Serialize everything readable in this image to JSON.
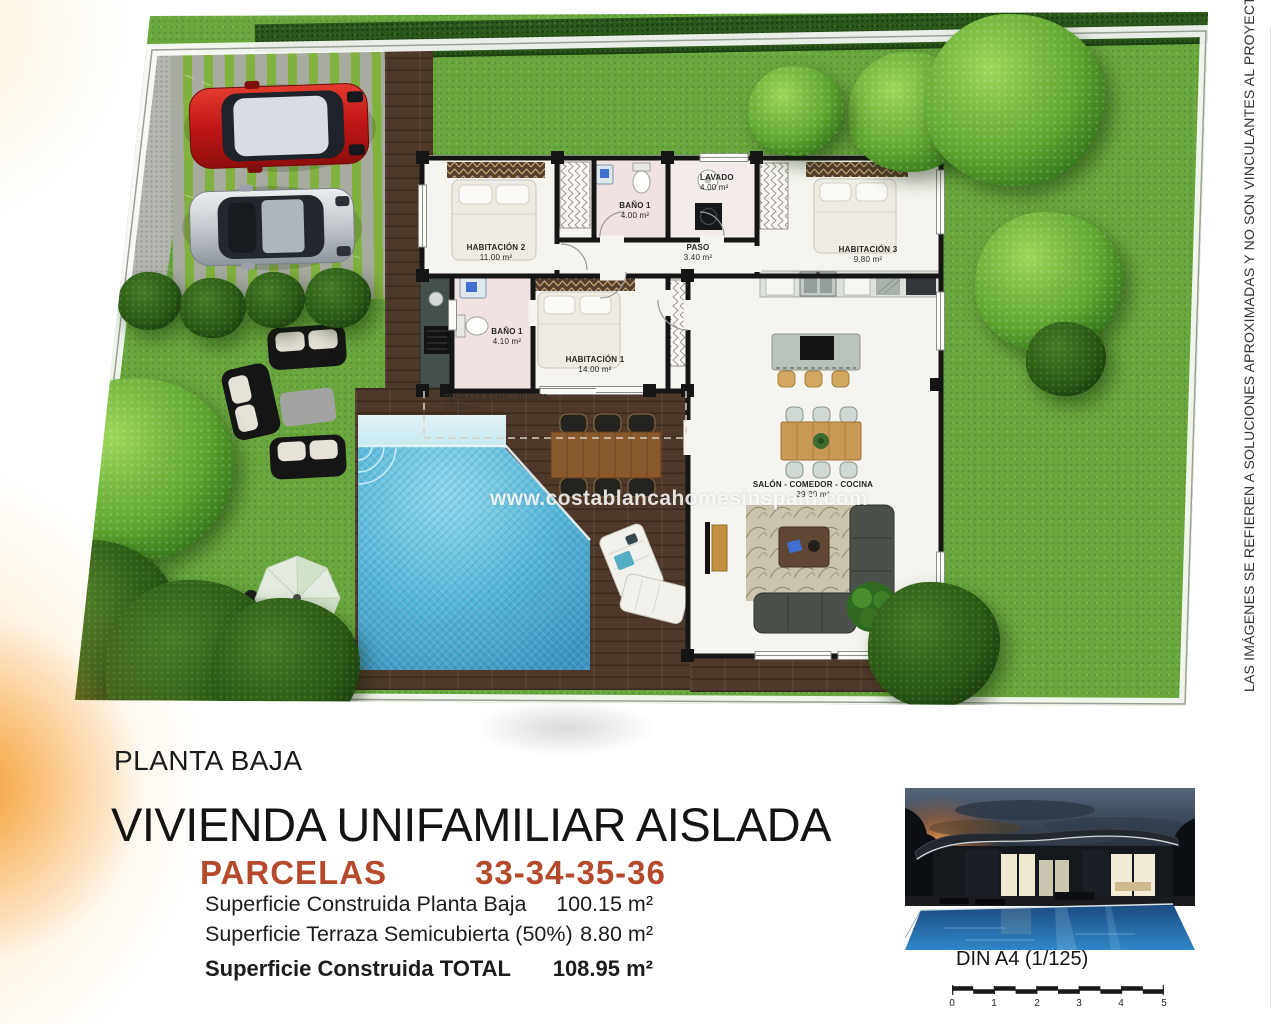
{
  "site_plan": {
    "watermark": "www.costablancahomesinspain.com",
    "rooms": {
      "habitacion2": {
        "name": "HABITACIÓN 2",
        "area": "11.00 m²"
      },
      "bano1_top": {
        "name": "BAÑO 1",
        "area": "4.00 m²"
      },
      "lavado": {
        "name": "LAVADO",
        "area": "4.00 m²"
      },
      "paso": {
        "name": "PASO",
        "area": "3.40 m²"
      },
      "habitacion3": {
        "name": "HABITACIÓN 3",
        "area": "9.80 m²"
      },
      "bano1_mid": {
        "name": "BAÑO 1",
        "area": "4.10 m²"
      },
      "habitacion1": {
        "name": "HABITACIÓN 1",
        "area": "14.00 m²"
      },
      "salon": {
        "name": "SALÓN - COMEDOR - COCINA",
        "area": "39.30 m²"
      },
      "terraza": {
        "name": "TERRAZA SEMICUBIERTA",
        "area": "17.60 m²"
      }
    }
  },
  "footer": {
    "floor_label": "PLANTA BAJA",
    "title": "VIVIENDA UNIFAMILIAR AISLADA",
    "parcels_label": "PARCELAS",
    "parcels_numbers": "33-34-35-36",
    "areas": {
      "row1": {
        "label": "Superficie Construida Planta Baja",
        "value": "100.15 m²"
      },
      "row2": {
        "label": "Superficie Terraza Semicubierta (50%)",
        "value": "8.80 m²"
      },
      "row3": {
        "label": "Superficie Construida TOTAL",
        "value": "108.95 m²"
      }
    },
    "scale": {
      "label": "DIN A4 (1/125)",
      "ticks": [
        "0",
        "1",
        "2",
        "3",
        "4",
        "5"
      ]
    }
  },
  "disclaimer": "LAS IMÁGENES SE REFIEREN A SOLUCIONES APROXIMADAS Y NO SON VINCULANTES AL PROYECTO FINAL",
  "colors": {
    "parcels_accent": "#b5492b",
    "grass": "#69a73e",
    "pool": "#57b4d6",
    "deck": "#4e382a",
    "walls": "#151515"
  }
}
